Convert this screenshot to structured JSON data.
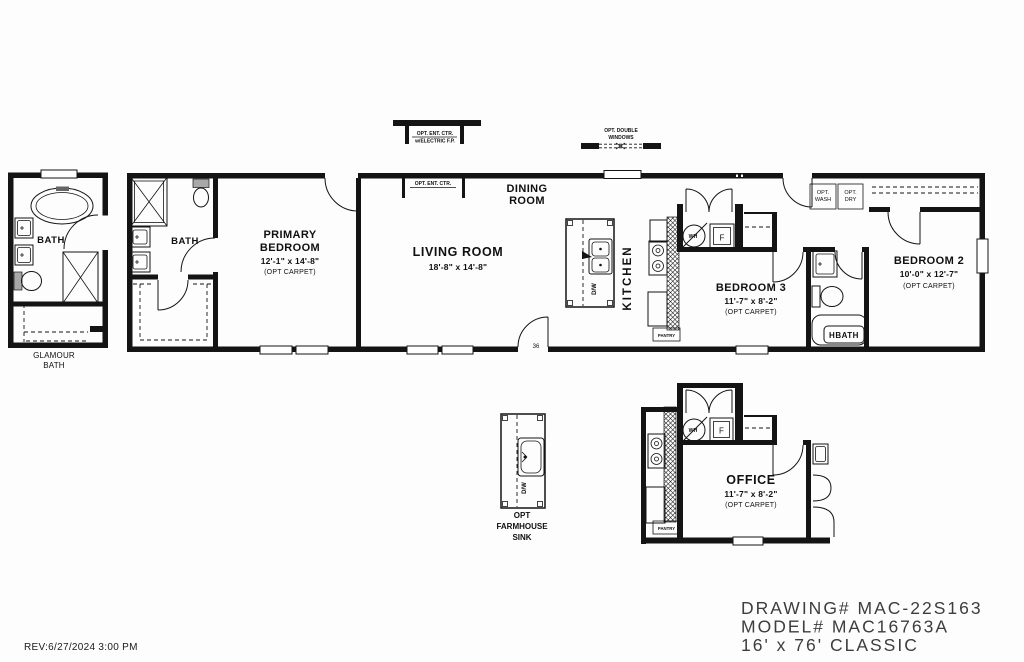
{
  "palette": {
    "ink": "#141414",
    "paper": "#ffffff",
    "title_text": "#3d3d3d"
  },
  "drawing": {
    "revision": "REV:6/27/2024 3:00 PM",
    "title_block": {
      "line1": "DRAWING# MAC-22S163",
      "line2": "MODEL# MAC16763A",
      "line3": "16' x 76' CLASSIC"
    }
  },
  "glamour_bath": {
    "bath_label": "BATH",
    "caption1": "GLAMOUR",
    "caption2": "BATH"
  },
  "main": {
    "primary_bath_label": "BATH",
    "primary_bedroom": {
      "l1": "PRIMARY",
      "l2": "BEDROOM",
      "dims": "12'-1\" x 14'-8\"",
      "opt": "(OPT CARPET)"
    },
    "living": {
      "name": "LIVING ROOM",
      "dims": "18'-8\" x 14'-8\""
    },
    "dining": {
      "l1": "DINING",
      "l2": "ROOM"
    },
    "kitchen": {
      "name": "KITCHEN",
      "dw": "D/W",
      "pantry": "PANTRY"
    },
    "utility": {
      "wh": "WH",
      "f": "F"
    },
    "laundry": {
      "wash1": "OPT.",
      "wash2": "WASH",
      "dry1": "OPT.",
      "dry2": "DRY"
    },
    "bedroom3": {
      "name": "BEDROOM 3",
      "dims": "11'-7\" x 8'-2\"",
      "opt": "(OPT CARPET)"
    },
    "hbath": {
      "label": "HBATH"
    },
    "bedroom2": {
      "name": "BEDROOM 2",
      "dims": "10'-0\" x 12'-7\"",
      "opt": "(OPT CARPET)"
    },
    "door36": "36",
    "opt_ent_fp": {
      "l1": "OPT. ENT. CTR.",
      "l2": "w/ELECTRIC F.P."
    },
    "opt_ent": "OPT. ENT. CTR.",
    "opt_dbl_win": {
      "l1": "OPT. DOUBLE",
      "l2": "WINDOWS"
    }
  },
  "options": {
    "farm": {
      "dw": "D/W",
      "c1": "OPT",
      "c2": "FARMHOUSE",
      "c3": "SINK"
    },
    "office": {
      "name": "OFFICE",
      "dims": "11'-7\" x 8'-2\"",
      "opt": "(OPT CARPET)",
      "wh": "WH",
      "f": "F",
      "pantry": "PANTRY"
    }
  }
}
